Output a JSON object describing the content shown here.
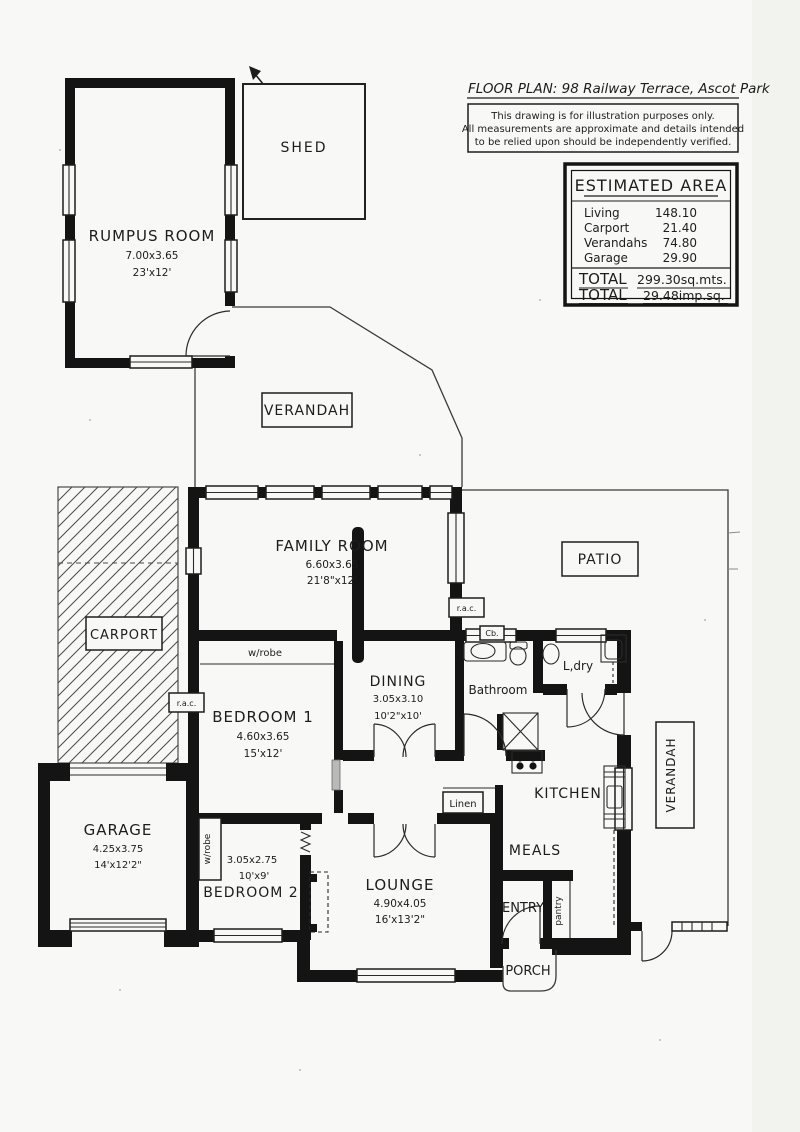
{
  "header": {
    "title": "FLOOR PLAN: 98 Railway Terrace, Ascot Park",
    "disclaimer1": "This drawing is for illustration purposes only.",
    "disclaimer2": "All measurements are approximate and details intended",
    "disclaimer3": "to be relied upon should be independently verified."
  },
  "area_table": {
    "title": "ESTIMATED AREA",
    "rows": [
      {
        "label": "Living",
        "value": "148.10"
      },
      {
        "label": "Carport",
        "value": "21.40"
      },
      {
        "label": "Verandahs",
        "value": "74.80"
      },
      {
        "label": "Garage",
        "value": "29.90"
      }
    ],
    "total1_label": "TOTAL",
    "total1_value": "299.30sq.mts.",
    "total2_label": "TOTAL",
    "total2_value": "29.48imp.sq."
  },
  "rooms": {
    "shed": {
      "name": "SHED"
    },
    "rumpus": {
      "name": "RUMPUS ROOM",
      "metric": "7.00x3.65",
      "imperial": "23'x12'"
    },
    "verandah_top": {
      "name": "VERANDAH"
    },
    "family": {
      "name": "FAMILY ROOM",
      "metric": "6.60x3.65",
      "imperial": "21'8\"x12'"
    },
    "patio": {
      "name": "PATIO"
    },
    "carport": {
      "name": "CARPORT"
    },
    "bedroom1": {
      "name": "BEDROOM 1",
      "metric": "4.60x3.65",
      "imperial": "15'x12'"
    },
    "dining": {
      "name": "DINING",
      "metric": "3.05x3.10",
      "imperial": "10'2\"x10'"
    },
    "bathroom": {
      "name": "Bathroom"
    },
    "laundry": {
      "name": "L,dry"
    },
    "kitchen": {
      "name": "KITCHEN"
    },
    "meals": {
      "name": "MEALS"
    },
    "verandah_right": {
      "name": "VERANDAH"
    },
    "garage": {
      "name": "GARAGE",
      "metric": "4.25x3.75",
      "imperial": "14'x12'2\""
    },
    "bedroom2": {
      "name": "BEDROOM 2",
      "metric": "3.05x2.75",
      "imperial": "10'x9'"
    },
    "lounge": {
      "name": "LOUNGE",
      "metric": "4.90x4.05",
      "imperial": "16'x13'2\""
    },
    "entry": {
      "name": "ENTRY"
    },
    "porch": {
      "name": "PORCH"
    }
  },
  "annotations": {
    "wrobe1": "w/robe",
    "wrobe2": "w/robe",
    "linen": "Linen",
    "pantry": "pantry",
    "cupboard": "Cb.",
    "rac_family": "r.a.c.",
    "rac_carport": "r.a.c."
  },
  "colors": {
    "ink": "#1d1d1d",
    "paper": "#f8f8f6"
  }
}
